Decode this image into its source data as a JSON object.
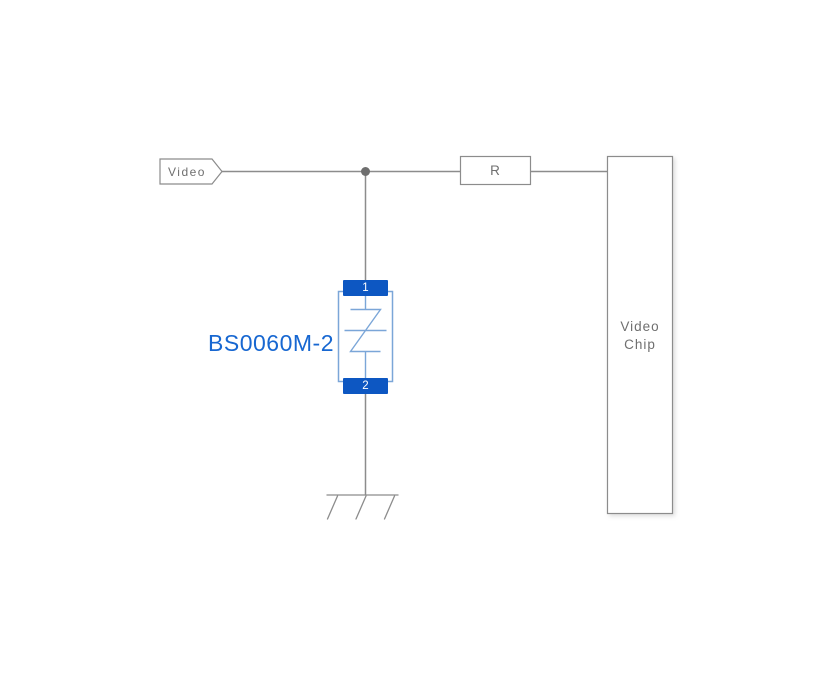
{
  "diagram": {
    "net_label": "Video",
    "resistor": {
      "label": "R"
    },
    "video_chip": {
      "label": "Video Chip"
    },
    "protection_device": {
      "part_number": "BS0060M-2",
      "pin_top": "1",
      "pin_bottom": "2"
    }
  },
  "colors": {
    "background": "#ffffff",
    "wire_gray": "#8c8c8c",
    "box_border_gray": "#8c8c8c",
    "junction_gray": "#6e6e6e",
    "text_gray": "#6f6f6f",
    "pad_blue": "#0d57c2",
    "symbol_light_blue": "#7ba6d8",
    "part_label_blue": "#1767d1"
  }
}
